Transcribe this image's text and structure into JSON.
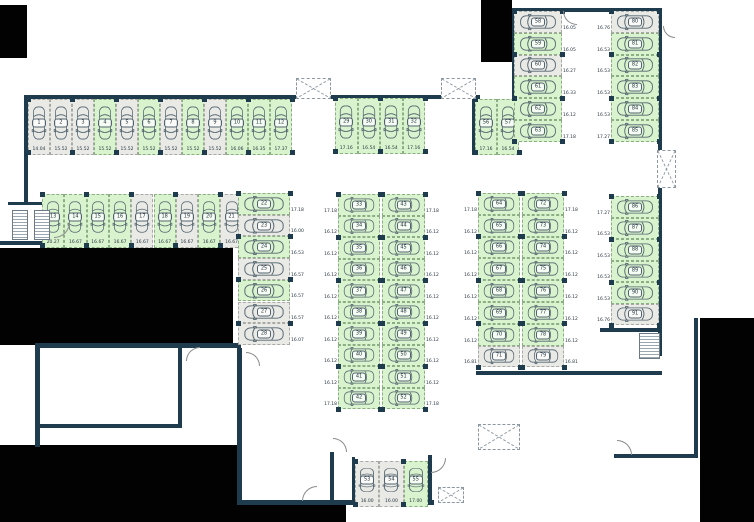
{
  "canvas": {
    "width": 754,
    "height": 522
  },
  "colors": {
    "wall": "#1e3c4e",
    "stall_free": "#d8f3cd",
    "stall_occupied": "#e9e9e6",
    "void": "#020202",
    "text": "#273740"
  },
  "sections": [
    {
      "id": "row-top-west",
      "dir": "row",
      "orient": "v",
      "x": 28,
      "y": 99,
      "cw": 22,
      "ch": 56,
      "label": "below",
      "stalls": [
        {
          "no": "1",
          "dim": "14.04",
          "state": "occupied"
        },
        {
          "no": "2",
          "dim": "15.52",
          "state": "occupied"
        },
        {
          "no": "3",
          "dim": "15.52",
          "state": "occupied"
        },
        {
          "no": "4",
          "dim": "15.52",
          "state": "free"
        },
        {
          "no": "5",
          "dim": "15.52",
          "state": "occupied"
        },
        {
          "no": "6",
          "dim": "15.52",
          "state": "free"
        },
        {
          "no": "7",
          "dim": "15.52",
          "state": "occupied"
        },
        {
          "no": "8",
          "dim": "15.52",
          "state": "free"
        },
        {
          "no": "9",
          "dim": "15.52",
          "state": "occupied"
        },
        {
          "no": "10",
          "dim": "16.06",
          "state": "free"
        },
        {
          "no": "11",
          "dim": "16.35",
          "state": "free"
        },
        {
          "no": "12",
          "dim": "17.37",
          "state": "free"
        }
      ]
    },
    {
      "id": "row-second-west",
      "dir": "row",
      "orient": "v",
      "x": 42,
      "y": 194,
      "cw": 22.3,
      "ch": 54,
      "label": "below",
      "stalls": [
        {
          "no": "13",
          "dim": "20.27",
          "state": "free"
        },
        {
          "no": "14",
          "dim": "16.67",
          "state": "free"
        },
        {
          "no": "15",
          "dim": "16.67",
          "state": "free"
        },
        {
          "no": "16",
          "dim": "16.67",
          "state": "free"
        },
        {
          "no": "17",
          "dim": "16.67",
          "state": "occupied"
        },
        {
          "no": "18",
          "dim": "16.67",
          "state": "free"
        },
        {
          "no": "19",
          "dim": "16.67",
          "state": "occupied"
        },
        {
          "no": "20",
          "dim": "16.67",
          "state": "free"
        },
        {
          "no": "21",
          "dim": "16.67",
          "state": "occupied"
        }
      ]
    },
    {
      "id": "col-west",
      "dir": "col",
      "orient": "h",
      "x": 238,
      "y": 193,
      "cw": 52,
      "ch": 21.7,
      "label": "right",
      "stalls": [
        {
          "no": "22",
          "dim": "17.18",
          "state": "free"
        },
        {
          "no": "23",
          "dim": "16.00",
          "state": "occupied"
        },
        {
          "no": "24",
          "dim": "16.53",
          "state": "free"
        },
        {
          "no": "25",
          "dim": "16.57",
          "state": "occupied"
        },
        {
          "no": "26",
          "dim": "16.57",
          "state": "free"
        },
        {
          "no": "27",
          "dim": "16.57",
          "state": "occupied"
        },
        {
          "no": "28",
          "dim": "16.07",
          "state": "occupied"
        }
      ]
    },
    {
      "id": "row-top-mid",
      "dir": "row",
      "orient": "v",
      "x": 335,
      "y": 98,
      "cw": 22.5,
      "ch": 56,
      "label": "below",
      "stalls": [
        {
          "no": "29",
          "dim": "17.16",
          "state": "free"
        },
        {
          "no": "30",
          "dim": "16.54",
          "state": "free"
        },
        {
          "no": "31",
          "dim": "16.54",
          "state": "free"
        },
        {
          "no": "32",
          "dim": "17.16",
          "state": "free"
        }
      ]
    },
    {
      "id": "col-mid-west",
      "dir": "col",
      "orient": "h",
      "x": 338,
      "y": 194,
      "cw": 42,
      "ch": 21.5,
      "label": "left",
      "stalls": [
        {
          "no": "33",
          "dim": "17.18",
          "state": "free"
        },
        {
          "no": "34",
          "dim": "16.12",
          "state": "free"
        },
        {
          "no": "35",
          "dim": "16.12",
          "state": "free"
        },
        {
          "no": "36",
          "dim": "16.12",
          "state": "free"
        },
        {
          "no": "37",
          "dim": "16.12",
          "state": "free"
        },
        {
          "no": "38",
          "dim": "16.12",
          "state": "free"
        },
        {
          "no": "39",
          "dim": "16.12",
          "state": "free"
        },
        {
          "no": "40",
          "dim": "16.12",
          "state": "free"
        },
        {
          "no": "41",
          "dim": "16.12",
          "state": "free"
        },
        {
          "no": "42",
          "dim": "17.18",
          "state": "free"
        }
      ]
    },
    {
      "id": "col-mid-east",
      "dir": "col",
      "orient": "h",
      "x": 382,
      "y": 194,
      "cw": 43,
      "ch": 21.5,
      "label": "right",
      "stalls": [
        {
          "no": "43",
          "dim": "17.18",
          "state": "free"
        },
        {
          "no": "44",
          "dim": "16.12",
          "state": "free"
        },
        {
          "no": "45",
          "dim": "16.12",
          "state": "free"
        },
        {
          "no": "46",
          "dim": "16.12",
          "state": "free"
        },
        {
          "no": "47",
          "dim": "16.12",
          "state": "free"
        },
        {
          "no": "48",
          "dim": "16.12",
          "state": "free"
        },
        {
          "no": "49",
          "dim": "16.12",
          "state": "free"
        },
        {
          "no": "50",
          "dim": "16.12",
          "state": "free"
        },
        {
          "no": "51",
          "dim": "16.12",
          "state": "free"
        },
        {
          "no": "52",
          "dim": "17.18",
          "state": "free"
        }
      ]
    },
    {
      "id": "row-bottom-mid",
      "dir": "row",
      "orient": "v",
      "x": 355,
      "y": 461,
      "cw": 24.3,
      "ch": 46,
      "label": "below",
      "stalls": [
        {
          "no": "53",
          "dim": "16.00",
          "state": "occupied"
        },
        {
          "no": "54",
          "dim": "16.00",
          "state": "occupied"
        },
        {
          "no": "55",
          "dim": "17.00",
          "state": "free"
        }
      ]
    },
    {
      "id": "row-top-east-small",
      "dir": "row",
      "orient": "v",
      "x": 475,
      "y": 99,
      "cw": 22,
      "ch": 56,
      "label": "below",
      "stalls": [
        {
          "no": "56",
          "dim": "17.16",
          "state": "free"
        },
        {
          "no": "57",
          "dim": "16.54",
          "state": "free"
        }
      ]
    },
    {
      "id": "col-ne-west",
      "dir": "col",
      "orient": "h",
      "x": 514,
      "y": 11,
      "cw": 48,
      "ch": 21.8,
      "label": "right",
      "stalls": [
        {
          "no": "58",
          "dim": "16.05",
          "state": "occupied"
        },
        {
          "no": "59",
          "dim": "16.05",
          "state": "free"
        },
        {
          "no": "60",
          "dim": "16.27",
          "state": "occupied"
        },
        {
          "no": "61",
          "dim": "16.33",
          "state": "free"
        },
        {
          "no": "62",
          "dim": "16.12",
          "state": "free"
        },
        {
          "no": "63",
          "dim": "17.18",
          "state": "free"
        }
      ]
    },
    {
      "id": "col-east-a",
      "dir": "col",
      "orient": "h",
      "x": 478,
      "y": 193,
      "cw": 42,
      "ch": 21.8,
      "label": "left",
      "stalls": [
        {
          "no": "64",
          "dim": "17.18",
          "state": "free"
        },
        {
          "no": "65",
          "dim": "16.12",
          "state": "free"
        },
        {
          "no": "66",
          "dim": "16.12",
          "state": "free"
        },
        {
          "no": "67",
          "dim": "16.12",
          "state": "free"
        },
        {
          "no": "68",
          "dim": "16.12",
          "state": "free"
        },
        {
          "no": "69",
          "dim": "16.12",
          "state": "free"
        },
        {
          "no": "70",
          "dim": "16.12",
          "state": "free"
        },
        {
          "no": "71",
          "dim": "16.81",
          "state": "occupied"
        }
      ]
    },
    {
      "id": "col-east-b",
      "dir": "col",
      "orient": "h",
      "x": 522,
      "y": 193,
      "cw": 42,
      "ch": 21.8,
      "label": "right",
      "stalls": [
        {
          "no": "72",
          "dim": "17.18",
          "state": "free"
        },
        {
          "no": "73",
          "dim": "16.12",
          "state": "free"
        },
        {
          "no": "74",
          "dim": "16.12",
          "state": "free"
        },
        {
          "no": "75",
          "dim": "16.12",
          "state": "free"
        },
        {
          "no": "76",
          "dim": "16.12",
          "state": "free"
        },
        {
          "no": "77",
          "dim": "16.12",
          "state": "free"
        },
        {
          "no": "78",
          "dim": "16.12",
          "state": "free"
        },
        {
          "no": "79",
          "dim": "16.81",
          "state": "occupied"
        }
      ]
    },
    {
      "id": "col-ne-east",
      "dir": "col",
      "orient": "h",
      "x": 611,
      "y": 11,
      "cw": 48,
      "ch": 21.8,
      "label": "left",
      "stalls": [
        {
          "no": "80",
          "dim": "16.76",
          "state": "occupied"
        },
        {
          "no": "81",
          "dim": "16.53",
          "state": "free"
        },
        {
          "no": "82",
          "dim": "16.53",
          "state": "free"
        },
        {
          "no": "83",
          "dim": "16.53",
          "state": "free"
        },
        {
          "no": "84",
          "dim": "16.53",
          "state": "free"
        },
        {
          "no": "85",
          "dim": "17.27",
          "state": "free"
        }
      ]
    },
    {
      "id": "col-se",
      "dir": "col",
      "orient": "h",
      "x": 611,
      "y": 196,
      "cw": 48,
      "ch": 21.5,
      "label": "left",
      "stalls": [
        {
          "no": "86",
          "dim": "17.27",
          "state": "free"
        },
        {
          "no": "87",
          "dim": "16.53",
          "state": "free"
        },
        {
          "no": "88",
          "dim": "16.53",
          "state": "free"
        },
        {
          "no": "89",
          "dim": "16.53",
          "state": "free"
        },
        {
          "no": "90",
          "dim": "16.53",
          "state": "free"
        },
        {
          "no": "91",
          "dim": "16.76",
          "state": "occupied"
        }
      ]
    }
  ],
  "walls": [
    [
      24,
      95,
      268,
      4
    ],
    [
      292,
      95,
      188,
      4
    ],
    [
      24,
      99,
      4,
      106
    ],
    [
      8,
      202,
      48,
      3
    ],
    [
      0,
      241,
      84,
      4
    ],
    [
      53,
      202,
      3,
      42
    ],
    [
      472,
      99,
      4,
      56
    ],
    [
      512,
      8,
      4,
      91
    ],
    [
      512,
      8,
      150,
      4
    ],
    [
      658,
      8,
      4,
      144
    ],
    [
      658,
      186,
      4,
      170
    ],
    [
      600,
      328,
      62,
      4
    ],
    [
      35,
      343,
      206,
      5
    ],
    [
      35,
      343,
      5,
      104
    ],
    [
      237,
      348,
      5,
      157
    ],
    [
      178,
      348,
      4,
      80
    ],
    [
      35,
      424,
      146,
      4
    ],
    [
      240,
      500,
      194,
      5
    ],
    [
      330,
      452,
      4,
      52
    ],
    [
      352,
      457,
      3,
      46
    ],
    [
      428,
      455,
      4,
      49
    ],
    [
      476,
      371,
      186,
      4
    ],
    [
      614,
      454,
      84,
      4
    ],
    [
      694,
      318,
      4,
      140
    ]
  ],
  "voids": [
    [
      0,
      5,
      27,
      53
    ],
    [
      481,
      0,
      31,
      62
    ],
    [
      0,
      248,
      233,
      97
    ],
    [
      0,
      445,
      242,
      77
    ],
    [
      242,
      505,
      104,
      17
    ],
    [
      700,
      318,
      54,
      204
    ]
  ],
  "vents": [
    [
      296,
      78,
      35,
      21
    ],
    [
      441,
      78,
      35,
      21
    ],
    [
      657,
      150,
      19,
      38
    ],
    [
      478,
      424,
      42,
      26
    ],
    [
      438,
      487,
      26,
      16
    ]
  ],
  "stairs": [
    [
      12,
      210,
      16,
      30
    ],
    [
      34,
      210,
      16,
      30
    ],
    [
      639,
      333,
      21,
      26
    ]
  ],
  "arcs": [
    {
      "x": 54,
      "y": 222,
      "s": 16,
      "q": "q4"
    },
    {
      "x": 563,
      "y": 11,
      "s": 14,
      "q": "q3"
    },
    {
      "x": 186,
      "y": 347,
      "s": 14,
      "q": "q2"
    },
    {
      "x": 246,
      "y": 352,
      "s": 14,
      "q": "q1"
    },
    {
      "x": 302,
      "y": 486,
      "s": 15,
      "q": "q2"
    },
    {
      "x": 333,
      "y": 438,
      "s": 14,
      "q": "q1"
    },
    {
      "x": 431,
      "y": 458,
      "s": 15,
      "q": "q4"
    },
    {
      "x": 617,
      "y": 440,
      "s": 15,
      "q": "q1"
    },
    {
      "x": 663,
      "y": 26,
      "s": 12,
      "q": "q3"
    }
  ]
}
